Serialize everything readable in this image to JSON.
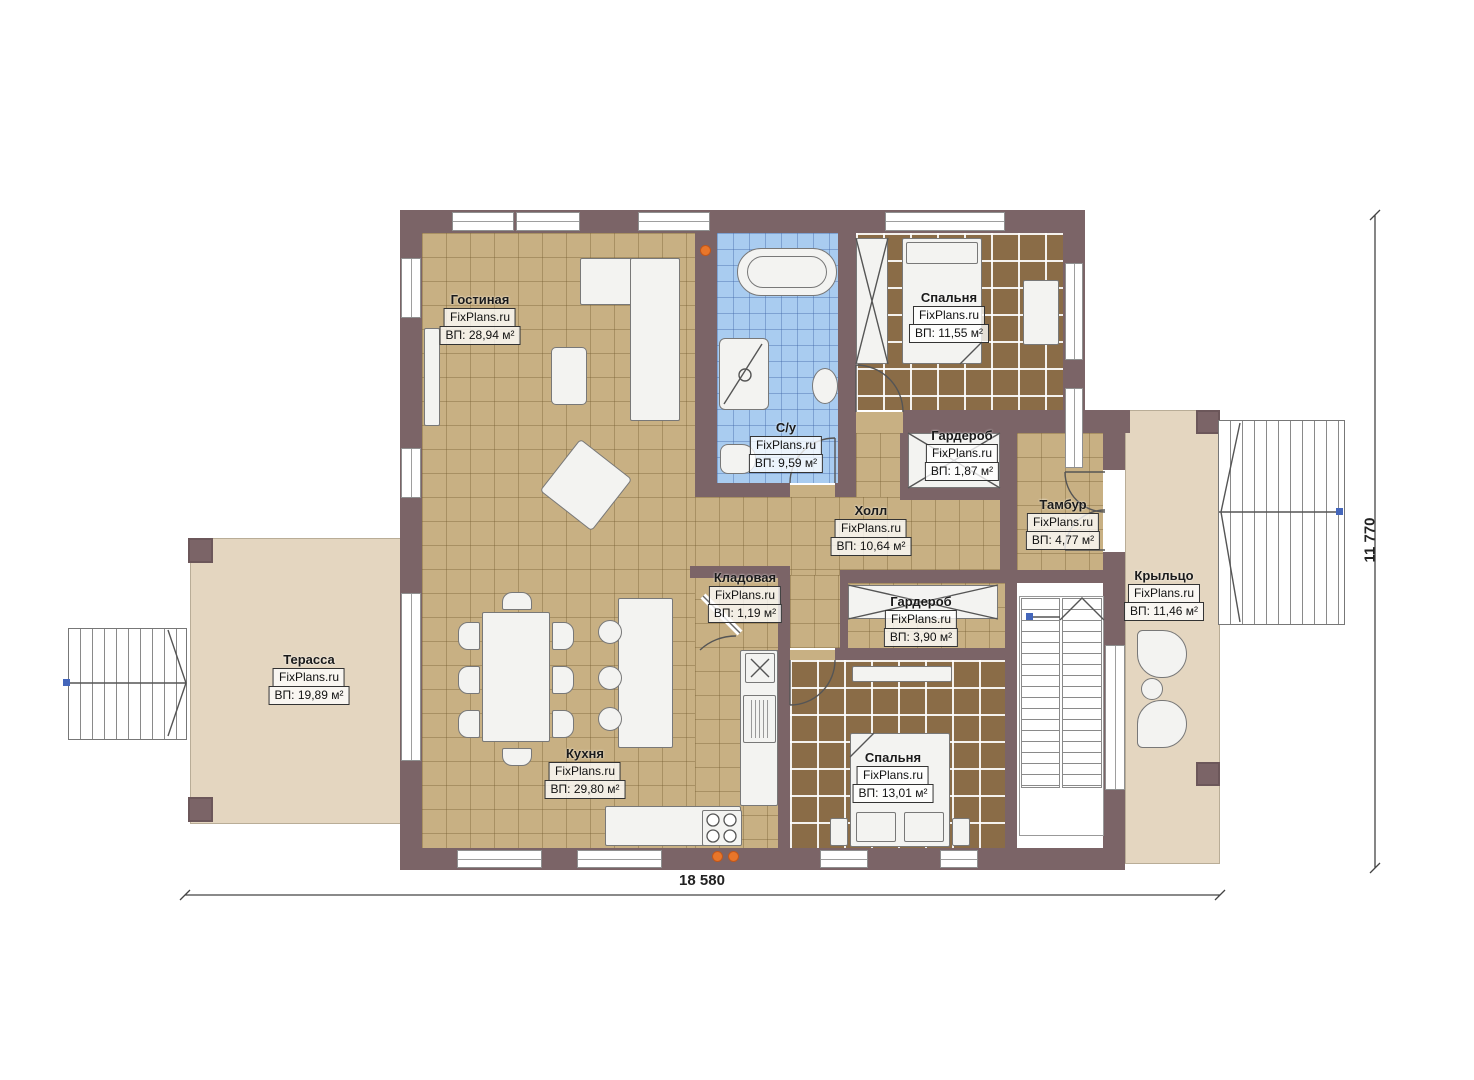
{
  "watermark": "FixPlans.ru",
  "rooms": [
    {
      "name": "Гостиная",
      "area": "ВП: 28,94 м²"
    },
    {
      "name": "С/у",
      "area": "ВП: 9,59 м²"
    },
    {
      "name": "Спальня",
      "area": "ВП: 11,55 м²"
    },
    {
      "name": "Гардероб",
      "area": "ВП: 1,87 м²"
    },
    {
      "name": "Тамбур",
      "area": "ВП: 4,77 м²"
    },
    {
      "name": "Холл",
      "area": "ВП: 10,64 м²"
    },
    {
      "name": "Кладовая",
      "area": "ВП: 1,19 м²"
    },
    {
      "name": "Гардероб",
      "area": "ВП: 3,90 м²"
    },
    {
      "name": "Крыльцо",
      "area": "ВП: 11,46 м²"
    },
    {
      "name": "Терасса",
      "area": "ВП: 19,89 м²"
    },
    {
      "name": "Кухня",
      "area": "ВП: 29,80 м²"
    },
    {
      "name": "Спальня",
      "area": "ВП: 13,01 м²"
    }
  ],
  "dimensions": {
    "width": "18 580",
    "height": "11 770"
  },
  "colors": {
    "wall": "#7b6467",
    "floor_tile": "#c8b083",
    "floor_wood": "#8a6c47",
    "floor_bath": "#a9ccf0",
    "floor_outdoor": "#e4d6c0",
    "accent_dot": "#e8762a",
    "dim_handle": "#4466bb"
  }
}
